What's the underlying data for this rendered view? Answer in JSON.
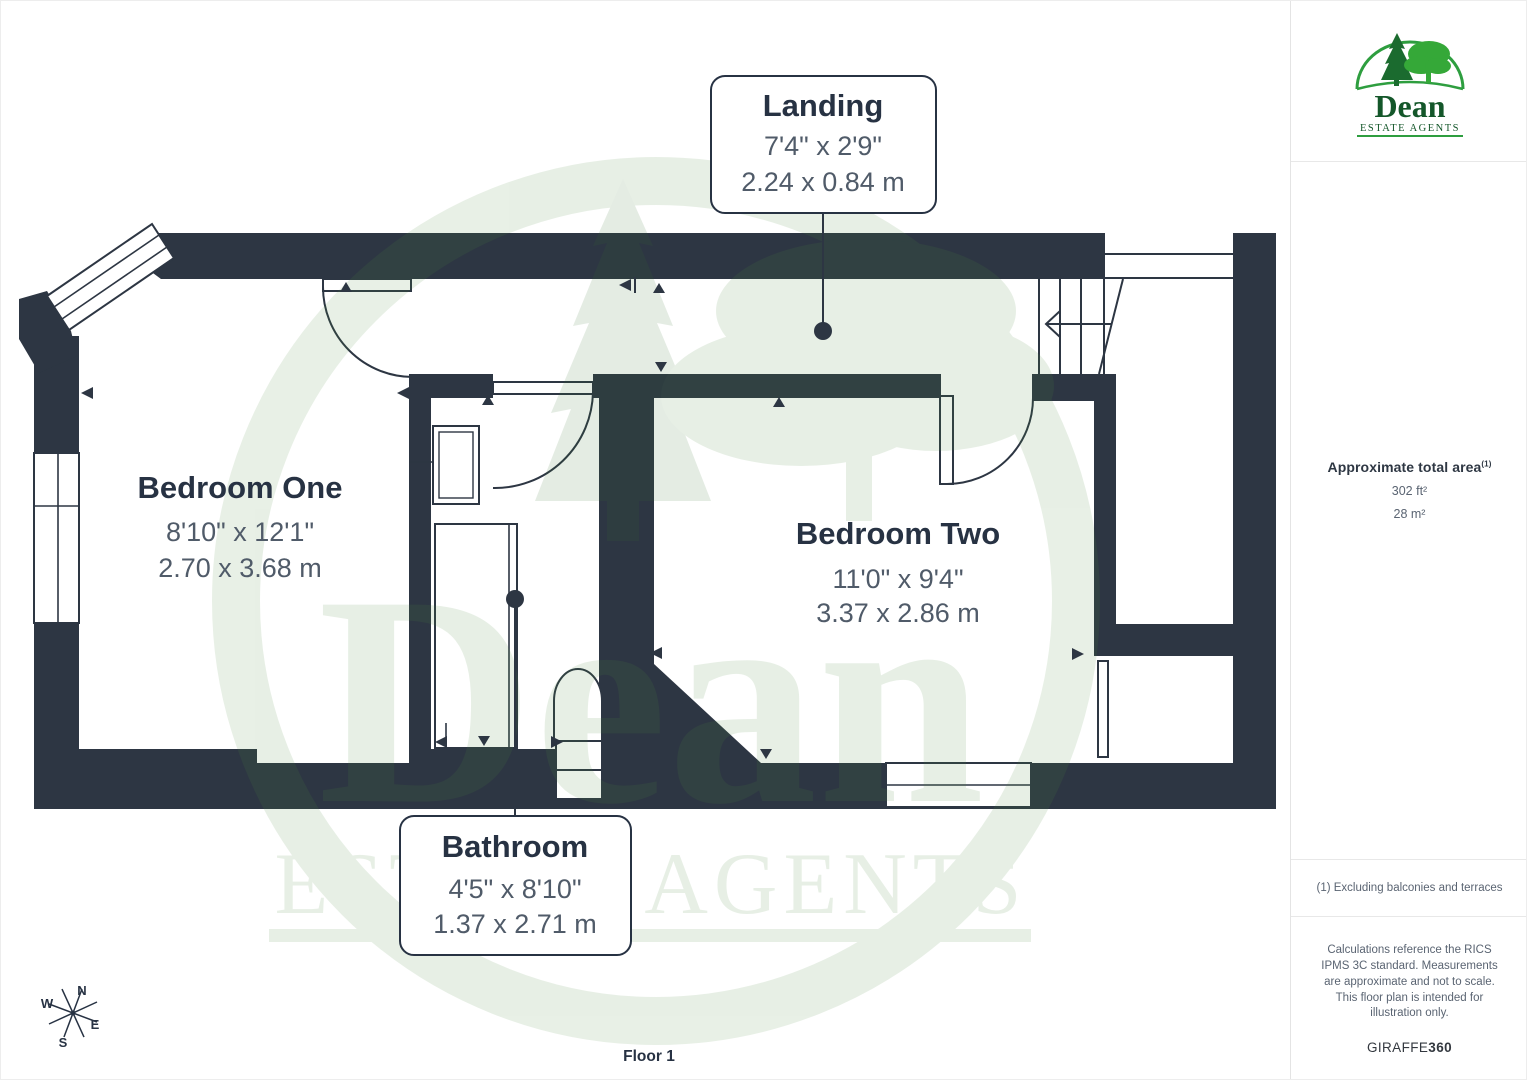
{
  "page": {
    "floor_label": "Floor 1"
  },
  "floorplan": {
    "rooms": [
      {
        "name": "Landing",
        "imperial": "7'4\" x 2'9\"",
        "metric": "2.24 x 0.84 m"
      },
      {
        "name": "Bedroom One",
        "imperial": "8'10\" x 12'1\"",
        "metric": "2.70 x 3.68 m"
      },
      {
        "name": "Bedroom Two",
        "imperial": "11'0\" x 9'4\"",
        "metric": "3.37 x 2.86 m"
      },
      {
        "name": "Bathroom",
        "imperial": "4'5\" x 8'10\"",
        "metric": "1.37 x 2.71 m"
      }
    ],
    "compass": {
      "north": "N",
      "east": "E",
      "south": "S",
      "west": "W"
    }
  },
  "watermark": {
    "name": "Dean",
    "subtitle": "ESTATE AGENTS"
  },
  "sidebar": {
    "logo": {
      "name": "Dean",
      "subtitle": "ESTATE AGENTS"
    },
    "area": {
      "title": "Approximate total area",
      "footnote_ref": "(1)",
      "imperial": "302 ft²",
      "metric": "28 m²"
    },
    "footnote": "(1) Excluding balconies and terraces",
    "disclaimer": "Calculations reference the RICS IPMS 3C standard. Measurements are approximate and not to scale. This floor plan is intended for illustration only.",
    "brand": {
      "name": "GIRAFFE",
      "suffix": "360"
    }
  },
  "colors": {
    "wall": "#2d3643",
    "label_text": "#273243",
    "dimension_text": "#505b69",
    "logo_green": "#1e7a33",
    "watermark_green": "#4c8a3f"
  }
}
